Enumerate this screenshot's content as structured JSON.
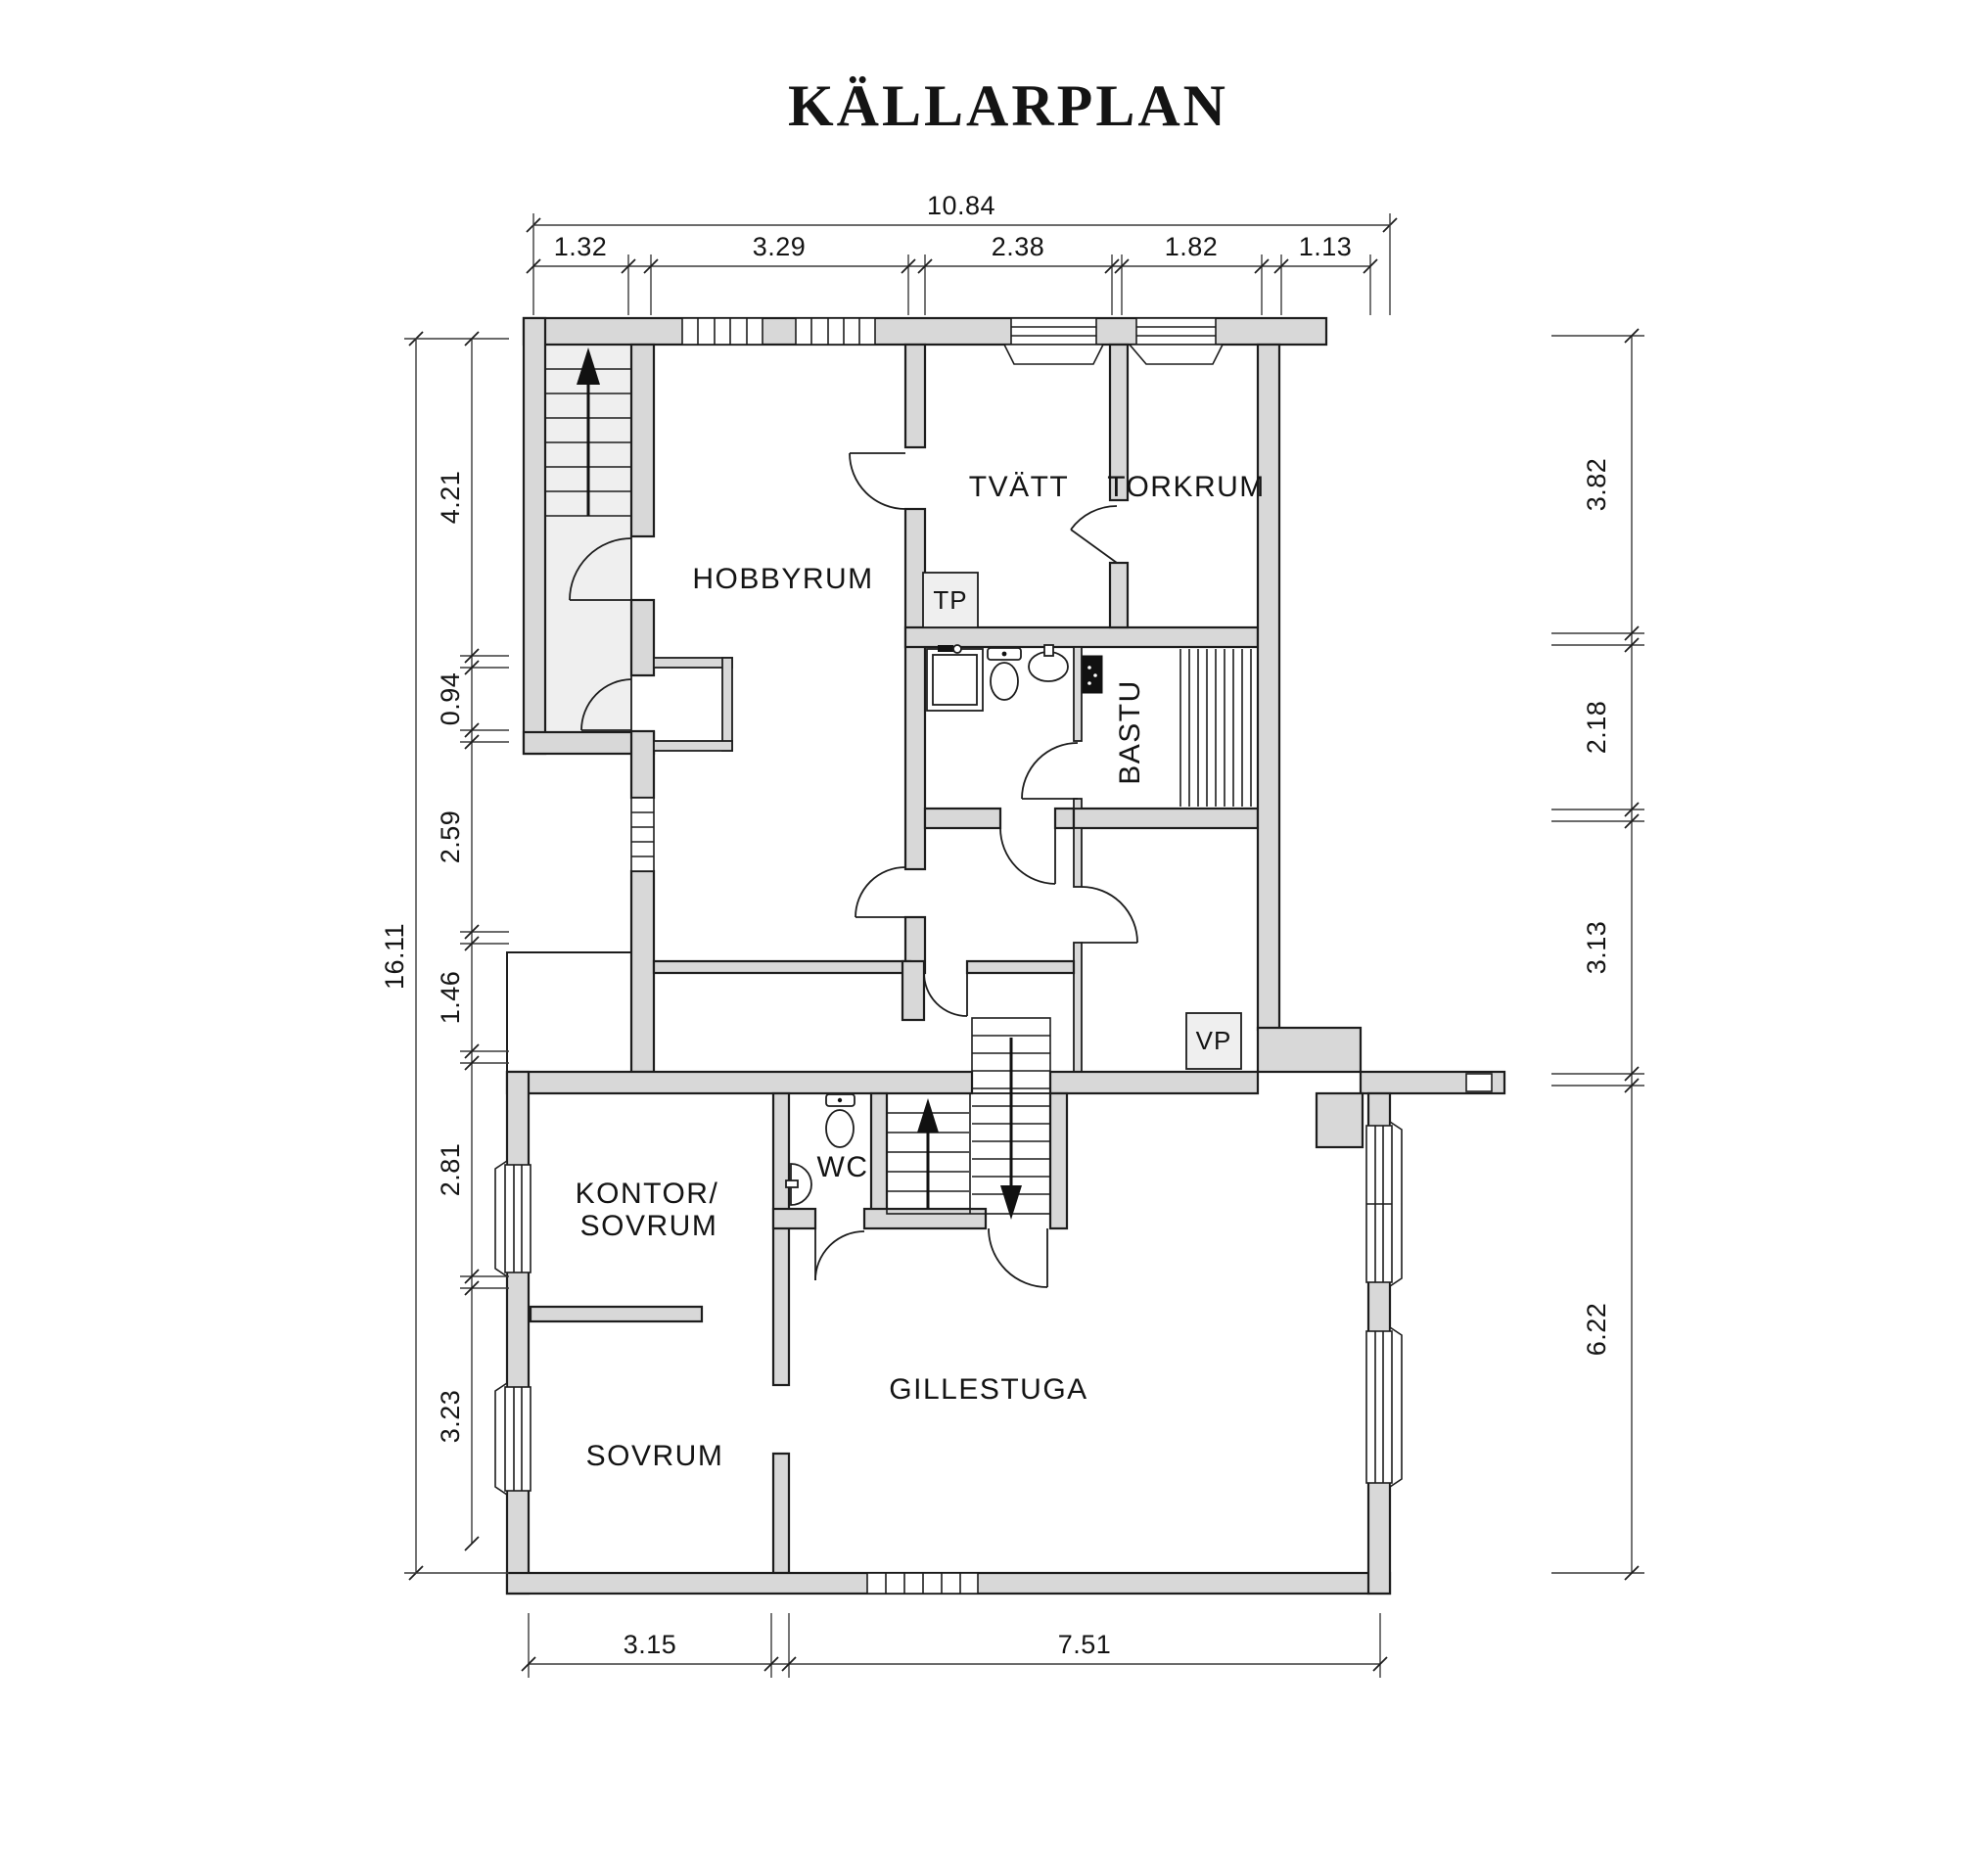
{
  "title": "KÄLLARPLAN",
  "rooms": {
    "hobbyrum": "HOBBYRUM",
    "tvatt": "TVÄTT",
    "torkrum": "TORKRUM",
    "bastu": "BASTU",
    "wc": "WC",
    "kontor_sovrum_line1": "KONTOR/",
    "kontor_sovrum_line2": "SOVRUM",
    "sovrum": "SOVRUM",
    "gillestuga": "GILLESTUGA",
    "tp_unit": "TP",
    "vp_unit": "VP"
  },
  "dimensions": {
    "top": {
      "total": "10.84",
      "segments": [
        "1.32",
        "3.29",
        "2.38",
        "1.82",
        "1.13"
      ]
    },
    "left": {
      "total": "16.11",
      "segments": [
        "4.21",
        "0.94",
        "2.59",
        "1.46",
        "2.81",
        "3.23"
      ]
    },
    "right": {
      "segments": [
        "3.82",
        "2.18",
        "3.13",
        "6.22"
      ]
    },
    "bottom": {
      "segments": [
        "3.15",
        "7.51"
      ]
    }
  },
  "icons": [
    "stairs-up-arrow-icon",
    "stairs-down-arrow-icon",
    "toilet-icon",
    "sink-icon",
    "shower-icon",
    "sauna-heater-icon",
    "sauna-bench-icon",
    "window-icon",
    "door-arc-icon"
  ],
  "colors": {
    "wall_fill": "#d8d8d8",
    "stair_fill": "#efefef",
    "line": "#1d1d1d",
    "dimension_line": "#3a3a3a",
    "background": "#ffffff"
  }
}
